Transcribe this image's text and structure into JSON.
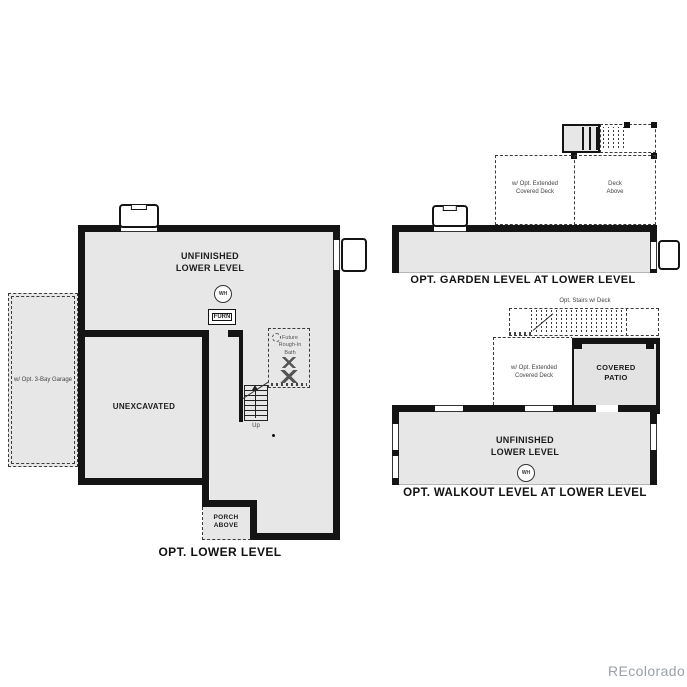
{
  "colors": {
    "wall": "#141414",
    "room_fill": "#e7e7e7",
    "patio_fill": "#e3e3e3",
    "watermark_gray": "#9aa0a6"
  },
  "plan_lower": {
    "title": "OPT. LOWER LEVEL",
    "main_label": "UNFINISHED\nLOWER LEVEL",
    "water_heater": "WH",
    "furnace": "FURN",
    "unexcavated": "UNEXCAVATED",
    "porch": "PORCH\nABOVE",
    "garage": "w/ Opt. 3-Bay Garage",
    "bath": "Future\nRough-In\nBath",
    "stairs_up": "Up"
  },
  "plan_garden": {
    "title": "OPT. GARDEN LEVEL AT LOWER LEVEL",
    "deck_ext": "w/ Opt. Extended\nCovered Deck",
    "deck_above": "Deck\nAbove"
  },
  "plan_walkout": {
    "title": "OPT. WALKOUT LEVEL AT LOWER LEVEL",
    "stairs_label": "Opt. Stairs w/ Deck",
    "deck_ext": "w/ Opt. Extended\nCovered Deck",
    "patio": "COVERED\nPATIO",
    "main_label": "UNFINISHED\nLOWER LEVEL",
    "water_heater": "WH"
  },
  "watermark": "REcolorado"
}
